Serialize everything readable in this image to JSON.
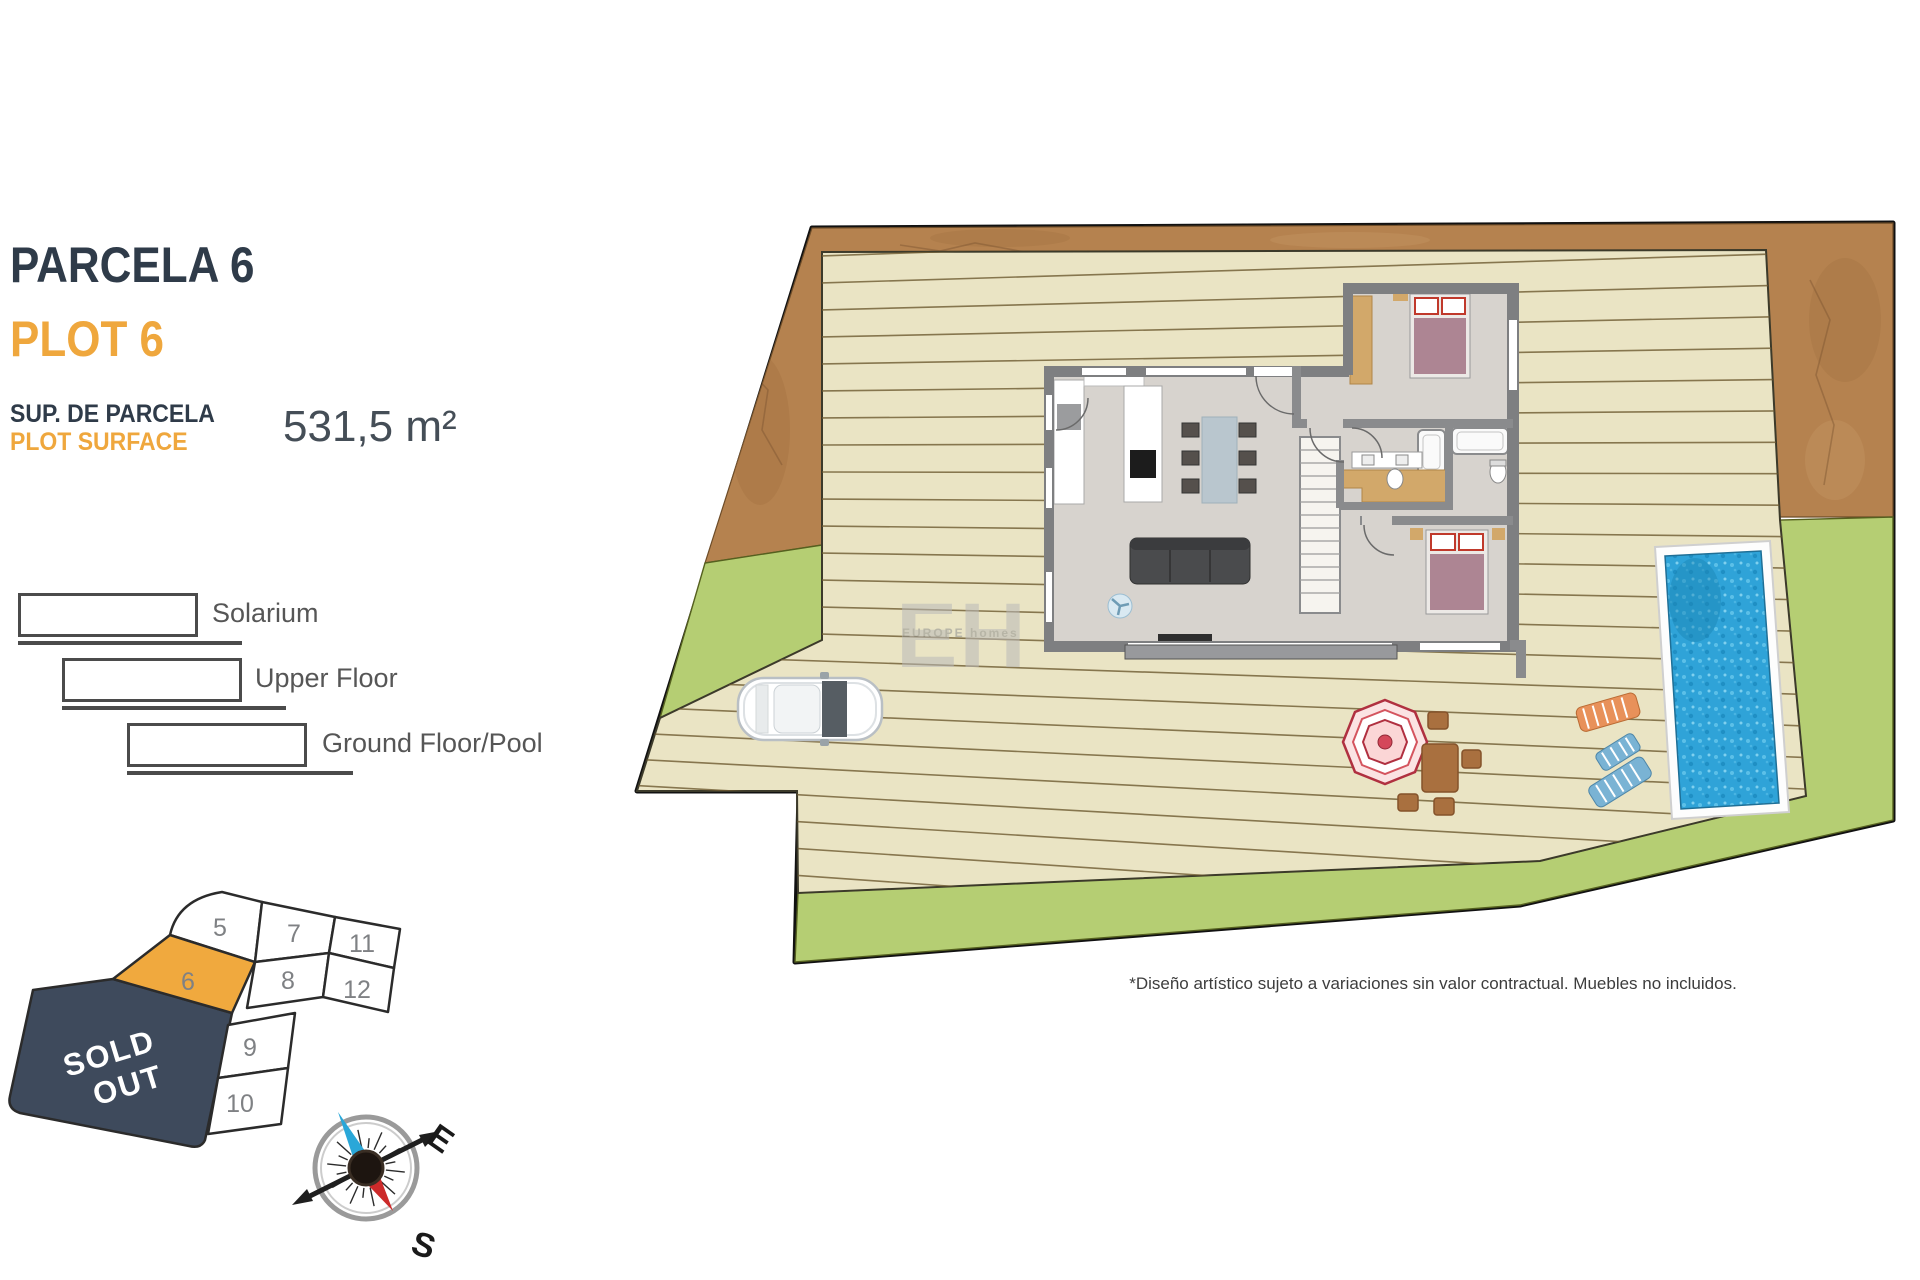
{
  "panel": {
    "title_primary": "PARCELA 6",
    "title_secondary": "PLOT 6",
    "surface_label_primary": "SUP. DE PARCELA",
    "surface_label_secondary": "PLOT SURFACE",
    "surface_value": "531,5 m²",
    "legend": [
      {
        "label": "Solarium"
      },
      {
        "label": "Upper Floor"
      },
      {
        "label": "Ground Floor/Pool"
      }
    ]
  },
  "minimap": {
    "sold_out_line1": "SOLD",
    "sold_out_line2": "OUT",
    "plots": {
      "p5": "5",
      "p7": "7",
      "p11": "11",
      "p6": "6",
      "p8": "8",
      "p12": "12",
      "p9": "9",
      "p10": "10"
    }
  },
  "compass": {
    "east_label": "E",
    "south_label": "S"
  },
  "siteplan": {
    "watermark_big": "EH",
    "watermark_small": "EUROPE homes"
  },
  "footer": {
    "disclaimer": "*Diseño artístico sujeto a variaciones sin valor contractual. Muebles no incluidos."
  },
  "colors": {
    "navy": "#2F3B49",
    "orange": "#EFA73D",
    "sold_navy": "#3E4A5C",
    "plot6_fill": "#F0A93E",
    "terrain_brown": "#B5824F",
    "grass_green": "#B5CE73",
    "deck_beige": "#EAE4C4",
    "pool_blue": "#2FA3D8"
  }
}
